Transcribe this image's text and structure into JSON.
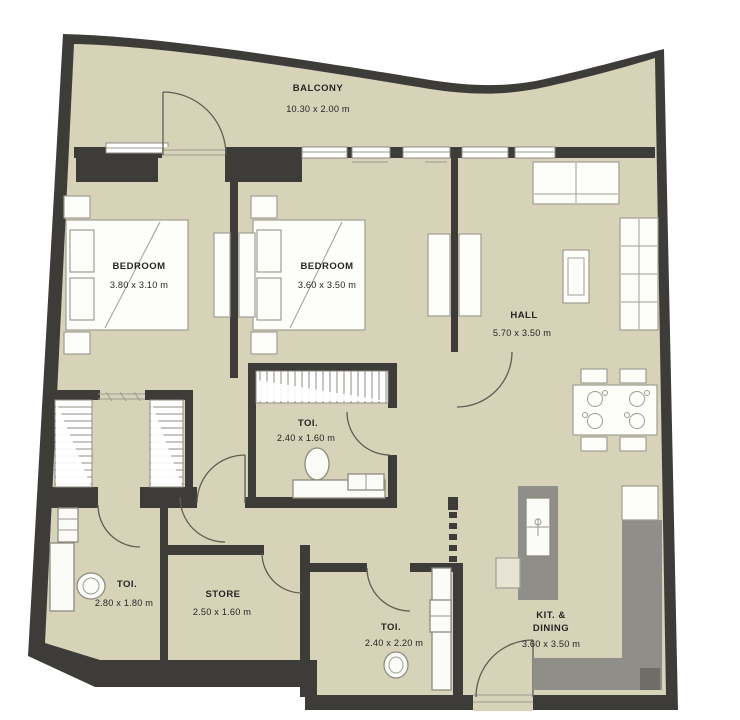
{
  "colors": {
    "wall": "#3e3c38",
    "floor": "#d7d3b9",
    "counter": "#8f8e88",
    "counter_dark": "#6e6d66",
    "line": "#a09e93",
    "door": "#5f5c55",
    "ink": "#262523"
  },
  "rooms": {
    "balcony": {
      "label": "BALCONY",
      "dims": "10.30 x 2.00 m"
    },
    "bedroom_left": {
      "label": "BEDROOM",
      "dims": "3.80 x 3.10 m"
    },
    "bedroom_mid": {
      "label": "BEDROOM",
      "dims": "3.60 x 3.50 m"
    },
    "hall": {
      "label": "HALL",
      "dims": "5.70 x 3.50 m"
    },
    "toilet_mid": {
      "label": "TOI.",
      "dims": "2.40 x 1.60 m"
    },
    "toilet_left": {
      "label": "TOI.",
      "dims": "2.80 x 1.80 m"
    },
    "store": {
      "label": "STORE",
      "dims": "2.50 x 1.60 m"
    },
    "toilet_bottom": {
      "label": "TOI.",
      "dims": "2.40 x 2.20 m"
    },
    "kitchen": {
      "label_line1": "KIT. &",
      "label_line2": "DINING",
      "dims": "3.60 x 3.50 m"
    }
  }
}
